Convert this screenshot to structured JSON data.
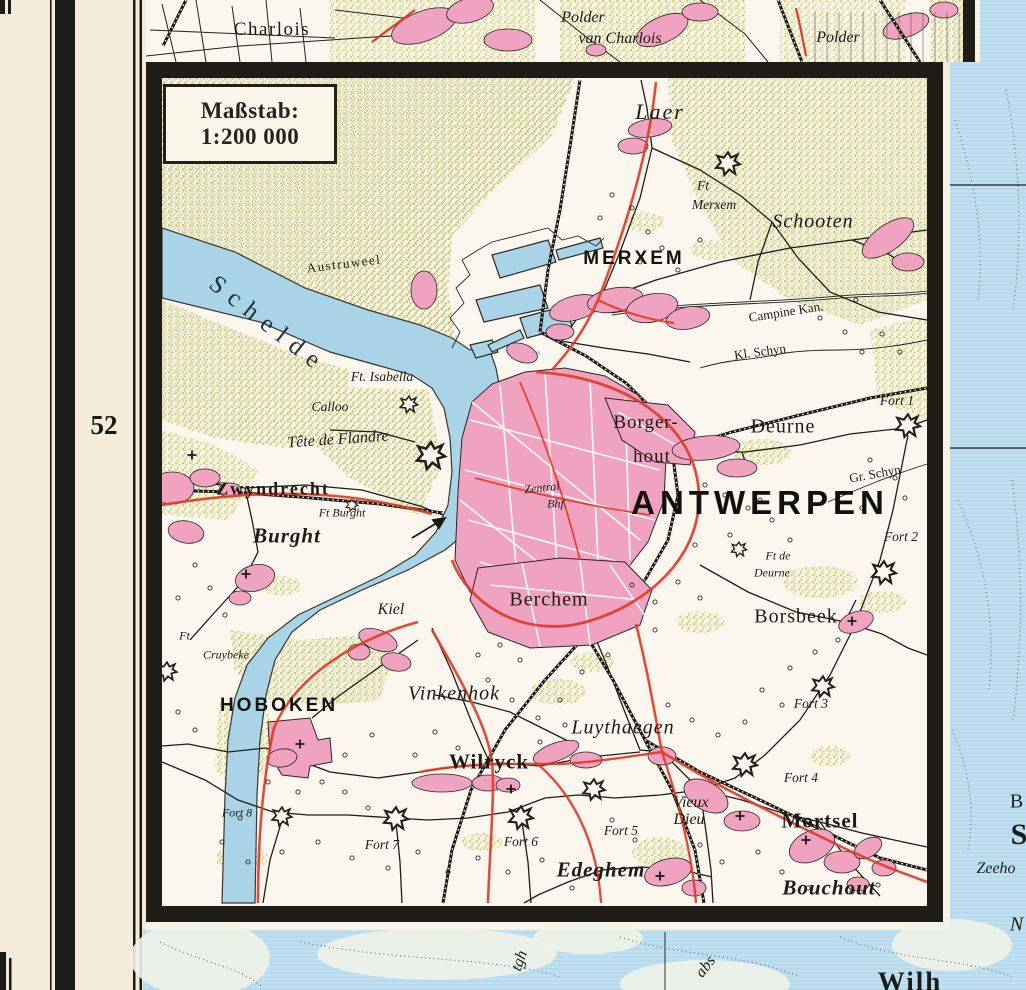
{
  "page": {
    "sheet_number": "52"
  },
  "scale_box": {
    "line1": "Maßstab:",
    "line2": "1:200 000"
  },
  "colors": {
    "paper": "#f4ecd9",
    "map_white": "#fbf7ef",
    "water": "#a9d3e6",
    "sea_light": "#bfe0f0",
    "town_pink": "#f0a3c0",
    "road_red": "#e23b27",
    "field_yellow": "#d9d25f",
    "frame_black": "#201d18"
  },
  "labels": [
    {
      "t": "Charlois",
      "x": 272,
      "y": 30,
      "c": "serif-md ls1"
    },
    {
      "t": "Polder",
      "x": 583,
      "y": 18,
      "c": "serif-it-md"
    },
    {
      "t": "van Charlois",
      "x": 620,
      "y": 39,
      "c": "serif-it-md"
    },
    {
      "t": "Polder",
      "x": 838,
      "y": 38,
      "c": "serif-it-md"
    },
    {
      "t": "Laer",
      "x": 660,
      "y": 112,
      "c": "serif-it-xl"
    },
    {
      "t": "Ft",
      "x": 703,
      "y": 186,
      "c": "serif-it-sm"
    },
    {
      "t": "Merxem",
      "x": 714,
      "y": 205,
      "c": "serif-it-sm"
    },
    {
      "t": "Schooten",
      "x": 813,
      "y": 222,
      "c": "serif-it-lg"
    },
    {
      "t": "MERXEM",
      "x": 634,
      "y": 259,
      "c": "caps-md"
    },
    {
      "t": "Austruweel",
      "x": 344,
      "y": 264,
      "c": "serif-sm ls1",
      "r": -7
    },
    {
      "t": "Schelde",
      "x": 268,
      "y": 325,
      "c": "water-lg",
      "r": 38
    },
    {
      "t": "Ft. Isabella",
      "x": 382,
      "y": 377,
      "c": "serif-it-sm"
    },
    {
      "t": "Calloo",
      "x": 330,
      "y": 407,
      "c": "serif-it-sm"
    },
    {
      "t": "Tête de Flandre",
      "x": 338,
      "y": 440,
      "c": "serif-it-md",
      "r": -4
    },
    {
      "t": "Zwyndrecht",
      "x": 273,
      "y": 489,
      "c": "serif-bold-md"
    },
    {
      "t": "Ft Burght",
      "x": 342,
      "y": 513,
      "c": "serif-it-xs"
    },
    {
      "t": "Burght",
      "x": 287,
      "y": 536,
      "c": "serif-bold-it-lg"
    },
    {
      "t": "Borger-",
      "x": 646,
      "y": 423,
      "c": "serif-md"
    },
    {
      "t": "hout",
      "x": 652,
      "y": 457,
      "c": "serif-md"
    },
    {
      "t": "Deurne",
      "x": 783,
      "y": 427,
      "c": "serif-lg"
    },
    {
      "t": "Fort 1",
      "x": 897,
      "y": 401,
      "c": "serif-it-sm"
    },
    {
      "t": "Gr. Schyn",
      "x": 875,
      "y": 474,
      "c": "serif-sm",
      "r": -10
    },
    {
      "t": "Fort 2",
      "x": 901,
      "y": 537,
      "c": "serif-it-sm"
    },
    {
      "t": "ANTWERPEN",
      "x": 760,
      "y": 503,
      "c": "caps-xl"
    },
    {
      "t": "Zentral",
      "x": 542,
      "y": 488,
      "c": "serif-it-xs",
      "r": -6
    },
    {
      "t": "Bhf.",
      "x": 557,
      "y": 504,
      "c": "serif-it-xs"
    },
    {
      "t": "Ft de",
      "x": 778,
      "y": 556,
      "c": "serif-it-xs"
    },
    {
      "t": "Deurne",
      "x": 772,
      "y": 573,
      "c": "serif-it-xs"
    },
    {
      "t": "Borsbeek",
      "x": 796,
      "y": 617,
      "c": "serif-lg"
    },
    {
      "t": "Berchem",
      "x": 549,
      "y": 600,
      "c": "serif-lg"
    },
    {
      "t": "Kiel",
      "x": 391,
      "y": 610,
      "c": "serif-it-md"
    },
    {
      "t": "Ft.",
      "x": 186,
      "y": 636,
      "c": "serif-it-xs"
    },
    {
      "t": "Cruybeke",
      "x": 226,
      "y": 655,
      "c": "serif-it-xs"
    },
    {
      "t": "HOBOKEN",
      "x": 279,
      "y": 706,
      "c": "caps-md"
    },
    {
      "t": "Vinkenhok",
      "x": 454,
      "y": 694,
      "c": "serif-it-lg"
    },
    {
      "t": "Luythaegen",
      "x": 623,
      "y": 728,
      "c": "serif-it-lg"
    },
    {
      "t": "Fort 3",
      "x": 811,
      "y": 704,
      "c": "serif-it-sm"
    },
    {
      "t": "Fort 4",
      "x": 801,
      "y": 778,
      "c": "serif-it-sm"
    },
    {
      "t": "Wilryck",
      "x": 489,
      "y": 762,
      "c": "serif-bold-lg"
    },
    {
      "t": "Vieux",
      "x": 691,
      "y": 803,
      "c": "serif-it-md"
    },
    {
      "t": "Dieu",
      "x": 689,
      "y": 820,
      "c": "serif-it-md"
    },
    {
      "t": "Mortsel",
      "x": 820,
      "y": 821,
      "c": "serif-bold-lg"
    },
    {
      "t": "Fort 5",
      "x": 621,
      "y": 831,
      "c": "serif-it-sm"
    },
    {
      "t": "Fort 6",
      "x": 521,
      "y": 842,
      "c": "serif-it-sm"
    },
    {
      "t": "Fort 7",
      "x": 382,
      "y": 845,
      "c": "serif-it-sm"
    },
    {
      "t": "Fort 8",
      "x": 237,
      "y": 813,
      "c": "serif-it-xs"
    },
    {
      "t": "Edeghem",
      "x": 601,
      "y": 870,
      "c": "serif-bold-it-lg"
    },
    {
      "t": "Bouchout",
      "x": 829,
      "y": 888,
      "c": "serif-bold-it-lg"
    },
    {
      "t": "Campine Kan.",
      "x": 786,
      "y": 312,
      "c": "serif-sm",
      "r": -9
    },
    {
      "t": "Kl. Schyn",
      "x": 760,
      "y": 352,
      "c": "serif-sm",
      "r": -8
    },
    {
      "t": "B",
      "x": 1017,
      "y": 802,
      "c": "serif-lg"
    },
    {
      "t": "S",
      "x": 1019,
      "y": 835,
      "c": "serif-xl"
    },
    {
      "t": "Zeeho",
      "x": 996,
      "y": 869,
      "c": "serif-it-md"
    },
    {
      "t": "N",
      "x": 1017,
      "y": 925,
      "c": "serif-it-lg"
    },
    {
      "t": "Wilh",
      "x": 910,
      "y": 982,
      "c": "serif-xxl"
    },
    {
      "t": "tgh",
      "x": 520,
      "y": 961,
      "c": "serif-it-md",
      "r": -70
    },
    {
      "t": "abs",
      "x": 706,
      "y": 967,
      "c": "serif-it-md",
      "r": -52
    }
  ],
  "icons": {
    "forts": [
      {
        "n": "ft-merxem",
        "x": 728,
        "y": 163,
        "s": 1.1
      },
      {
        "n": "fort-1",
        "x": 908,
        "y": 425,
        "s": 1.1
      },
      {
        "n": "fort-2",
        "x": 884,
        "y": 572,
        "s": 1.1
      },
      {
        "n": "ft-de-deurne",
        "x": 739,
        "y": 549,
        "s": 0.7
      },
      {
        "n": "fort-3",
        "x": 823,
        "y": 686,
        "s": 1.0
      },
      {
        "n": "fort-4",
        "x": 745,
        "y": 764,
        "s": 1.1
      },
      {
        "n": "fort-5",
        "x": 594,
        "y": 789,
        "s": 1.0
      },
      {
        "n": "fort-6",
        "x": 521,
        "y": 817,
        "s": 1.1
      },
      {
        "n": "fort-7",
        "x": 396,
        "y": 818,
        "s": 1.1
      },
      {
        "n": "fort-8",
        "x": 282,
        "y": 816,
        "s": 0.9
      },
      {
        "n": "tete-de-flandre",
        "x": 431,
        "y": 455,
        "s": 1.3
      },
      {
        "n": "ft-isabella",
        "x": 409,
        "y": 404,
        "s": 0.8
      },
      {
        "n": "ft-burght",
        "x": 352,
        "y": 505,
        "s": 0.55
      },
      {
        "n": "ft-cruybeke",
        "x": 167,
        "y": 671,
        "s": 0.9
      }
    ],
    "church_crosses": [
      {
        "x": 192,
        "y": 455
      },
      {
        "x": 246,
        "y": 574
      },
      {
        "x": 300,
        "y": 744
      },
      {
        "x": 511,
        "y": 789
      },
      {
        "x": 740,
        "y": 816
      },
      {
        "x": 806,
        "y": 840
      },
      {
        "x": 852,
        "y": 621
      },
      {
        "x": 660,
        "y": 876
      }
    ]
  }
}
